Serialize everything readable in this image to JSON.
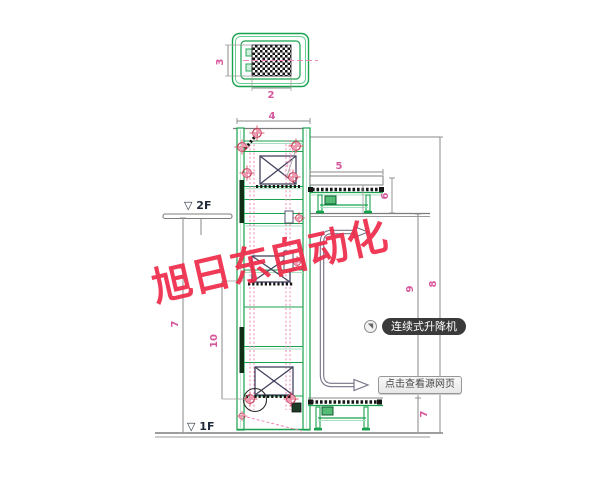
{
  "watermark": {
    "text": "旭日东自动化",
    "color": "#ee2b49"
  },
  "floor_labels": {
    "f2": "▽ 2F",
    "f1": "▽ 1F"
  },
  "dims": {
    "detail_height": "3",
    "detail_width": "2",
    "shaft_width": "4",
    "conveyor_top_length": "5",
    "conveyor_top_height": "6",
    "left_total_height": "7",
    "lift_inner_height": "10",
    "right_mid_span": "9",
    "right_full_span": "8",
    "bottom_conveyor_height": "7"
  },
  "tag": {
    "label": "连续式升降机"
  },
  "source_button": {
    "label": "点击查看源网页"
  },
  "icons": {
    "cursor_badge": "◥"
  },
  "colors": {
    "frame_green": "#18a24e",
    "dim_pink": "#d6569b",
    "marker_red": "#c43b55",
    "line_gray": "#8a8a8a",
    "watermark_red": "#ee2b49",
    "tag_bg": "#3a3a3a"
  }
}
